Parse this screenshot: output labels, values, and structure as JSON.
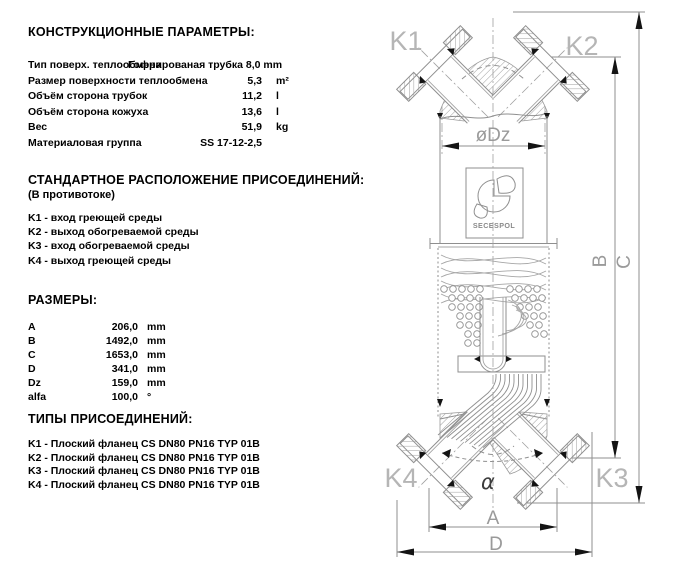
{
  "sections": {
    "construction": {
      "title": "КОНСТРУКЦИОННЫЕ ПАРАМЕТРЫ:",
      "rows": [
        {
          "label": "Тип поверх. теплообмена",
          "value": "Гофрированая трубка 8,0 mm",
          "unit": ""
        },
        {
          "label": "Размер поверхности теплообмена",
          "value": "5,3",
          "unit": "m²"
        },
        {
          "label": "Объём сторона трубок",
          "value": "11,2",
          "unit": "l"
        },
        {
          "label": "Объём сторона кожуха",
          "value": "13,6",
          "unit": "l"
        },
        {
          "label": "Вес",
          "value": "51,9",
          "unit": "kg"
        },
        {
          "label": "Материаловая группа",
          "value": "SS 17-12-2,5",
          "unit": ""
        }
      ]
    },
    "connections_layout": {
      "title": "СТАНДАРТНОЕ РАСПОЛОЖЕНИЕ ПРИСОЕДИНЕНИЙ:",
      "subtitle": "(В противотоке)",
      "items": [
        "K1 - вход греющей среды",
        "K2 - выход обогреваемой среды",
        "K3 - вход обогреваемой среды",
        "K4 - выход греющей среды"
      ]
    },
    "dimensions": {
      "title": "РАЗМЕРЫ:",
      "rows": [
        {
          "label": "A",
          "value": "206,0",
          "unit": "mm"
        },
        {
          "label": "B",
          "value": "1492,0",
          "unit": "mm"
        },
        {
          "label": "C",
          "value": "1653,0",
          "unit": "mm"
        },
        {
          "label": "D",
          "value": "341,0",
          "unit": "mm"
        },
        {
          "label": "Dz",
          "value": "159,0",
          "unit": "mm"
        },
        {
          "label": "alfa",
          "value": "100,0",
          "unit": "°"
        }
      ]
    },
    "connection_types": {
      "title": "ТИПЫ ПРИСОЕДИНЕНИЙ:",
      "items": [
        "K1 - Плоский фланец  CS  DN80 PN16 TYP 01B",
        "K2 - Плоский фланец  CS  DN80 PN16 TYP 01B",
        "K3 - Плоский фланец  CS  DN80 PN16 TYP 01B",
        "K4 - Плоский фланец  CS  DN80 PN16 TYP 01B"
      ]
    }
  },
  "diagram": {
    "labels": {
      "k1": "K1",
      "k2": "K2",
      "k3": "K3",
      "k4": "K4",
      "dz": "øDz",
      "a": "A",
      "b": "B",
      "c": "C",
      "d": "D",
      "alpha": "α"
    },
    "logo": "SECESPOL",
    "colors": {
      "line": "#8f8f8f",
      "connection_label": "#b5b5b5",
      "dimension_label": "#9a9a9a",
      "arrow": "#141414",
      "text": "#000000",
      "background": "#ffffff"
    }
  }
}
